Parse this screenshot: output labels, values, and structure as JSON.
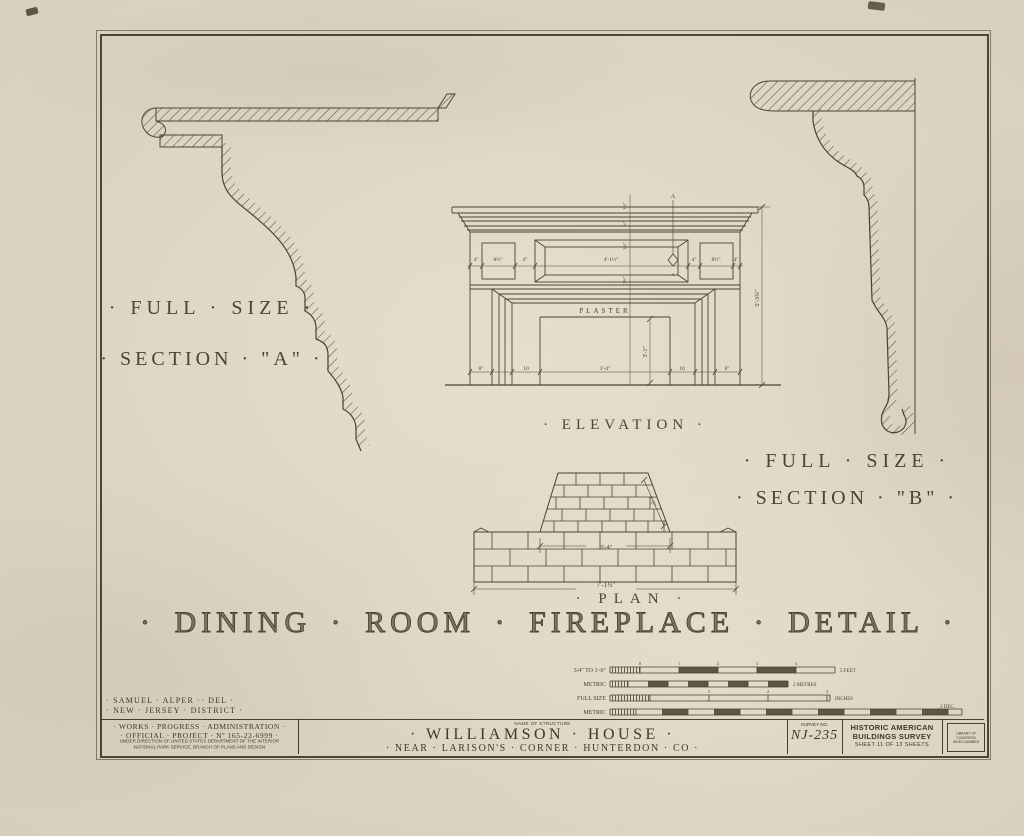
{
  "sheet_title": "· DINING · ROOM · FIREPLACE · DETAIL ·",
  "section_a": {
    "line1": "· FULL · SIZE ·",
    "line2": "· SECTION · \"A\" ·"
  },
  "section_b": {
    "line1": "· FULL · SIZE ·",
    "line2": "· SECTION · \"B\" ·"
  },
  "elevation": {
    "label": "· ELEVATION ·",
    "plaster": "PLASTER",
    "marker": "A",
    "frieze_dims": [
      "4\"",
      "8½\"",
      "4\"",
      "4'-1½\"",
      "4\"",
      "8½\"",
      "4\""
    ],
    "center_dims": [
      "1¾\"",
      "¾\"",
      "3¾\"",
      "1¾\""
    ],
    "bottom_dims": [
      "8\"",
      "10",
      "3'-4\"",
      "10",
      "8\""
    ],
    "opening_height": "3'-1\"",
    "overall_height": "5'-3¾\""
  },
  "plan": {
    "label": "· PLAN ·",
    "inner_width": "3'-4\"",
    "overall_width": "7'-1½\"",
    "slope_dim": "1'-2\""
  },
  "scales": {
    "row1": {
      "label": "3/4\" TO 1'-0\"",
      "ticks": [
        "0",
        "1",
        "2",
        "3",
        "4"
      ],
      "end": "5 FEET"
    },
    "row2": {
      "label": "METRIC",
      "end": "2 METRES"
    },
    "row3": {
      "label": "FULL SIZE",
      "ticks": [
        "1",
        "2",
        "3"
      ],
      "end": "INCHES"
    },
    "row4": {
      "label": "METRIC",
      "end": "2 DEC."
    }
  },
  "credits": {
    "line1": "· SAMUEL · ALPER ·· DEL ·",
    "line2": "· NEW · JERSEY · DISTRICT ·"
  },
  "titleblock": {
    "wpa1": "· WORKS · PROGRESS · ADMINISTRATION ·",
    "wpa2": "· OFFICIAL · PROJECT · Nº 165-22-6999 ·",
    "wpa3": "UNDER DIRECTION OF UNITED STATES DEPARTMENT OF THE INTERIOR",
    "wpa4": "NATIONAL PARK SERVICE, BRANCH OF PLANS AND DESIGN",
    "name_label": "NAME OF STRUCTURE",
    "name": "· WILLIAMSON · HOUSE ·",
    "location": "· NEAR · LARISON'S · CORNER · HUNTERDON · CO ·",
    "survey_label": "SURVEY NO.",
    "survey_no": "NJ-235",
    "habs1": "HISTORIC AMERICAN",
    "habs2": "BUILDINGS SURVEY",
    "habs3": "SHEET 11 OF 13 SHEETS",
    "loc1": "LIBRARY OF CONGRESS",
    "loc2": "INDEX NUMBER"
  },
  "colors": {
    "paper": "#d8cfbd",
    "ink": "#453e31",
    "border": "#4d4638"
  }
}
